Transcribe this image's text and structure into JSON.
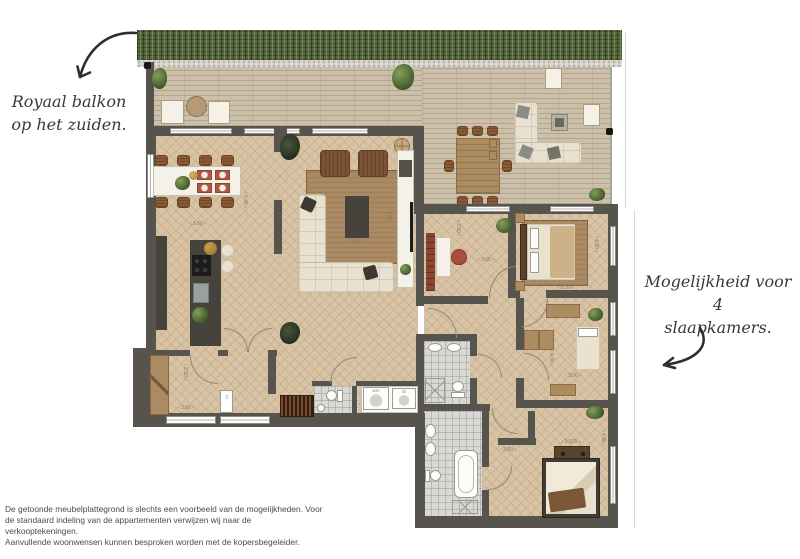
{
  "annotations": {
    "left": {
      "line1": "Royaal balkon",
      "line2": "op het zuiden."
    },
    "right": {
      "line1": "Mogelijkheid voor 4",
      "line2": "slaapkamers."
    }
  },
  "disclaimer": {
    "line1": "De getoonde meubelplattegrond is slechts een voorbeeld van de mogelijkheden. Voor",
    "line2": "de standaard indeling van de appartementen verwijzen wij naar de verkooptekeningen.",
    "line3": "Aanvullende woonwensen kunnen besproken worden met de kopersbegeleider."
  },
  "dimensions": [
    "‹ 5.60 ›",
    "‹ 5.40 ›",
    "‹ 5.60 ›",
    "‹ 3.05 ›",
    "‹ 3.05 ›",
    "‹ 3.60 ›",
    "‹ 3.70 ›",
    "‹ 4.60 ›",
    "‹ 3.00 ›",
    "‹ 4.00 ›",
    "‹ 3.625 ›",
    "‹ 4.50 ›",
    "‹ 2.00 ›",
    "‹ 2.60 ›",
    "‹ 2.50 ›"
  ],
  "appliance_labels": {
    "washer": "wm",
    "dryer": "dr",
    "meter_cupboard": "m"
  },
  "colors": {
    "wall": "#57544d",
    "floor": "#d8c3a5",
    "deck": "#ccc0aa",
    "hedge": "#56693e",
    "tile": "#d8d8d4",
    "accent_red": "#ae5742",
    "plant_green": "#4d6534",
    "ink": "#3a3833"
  }
}
